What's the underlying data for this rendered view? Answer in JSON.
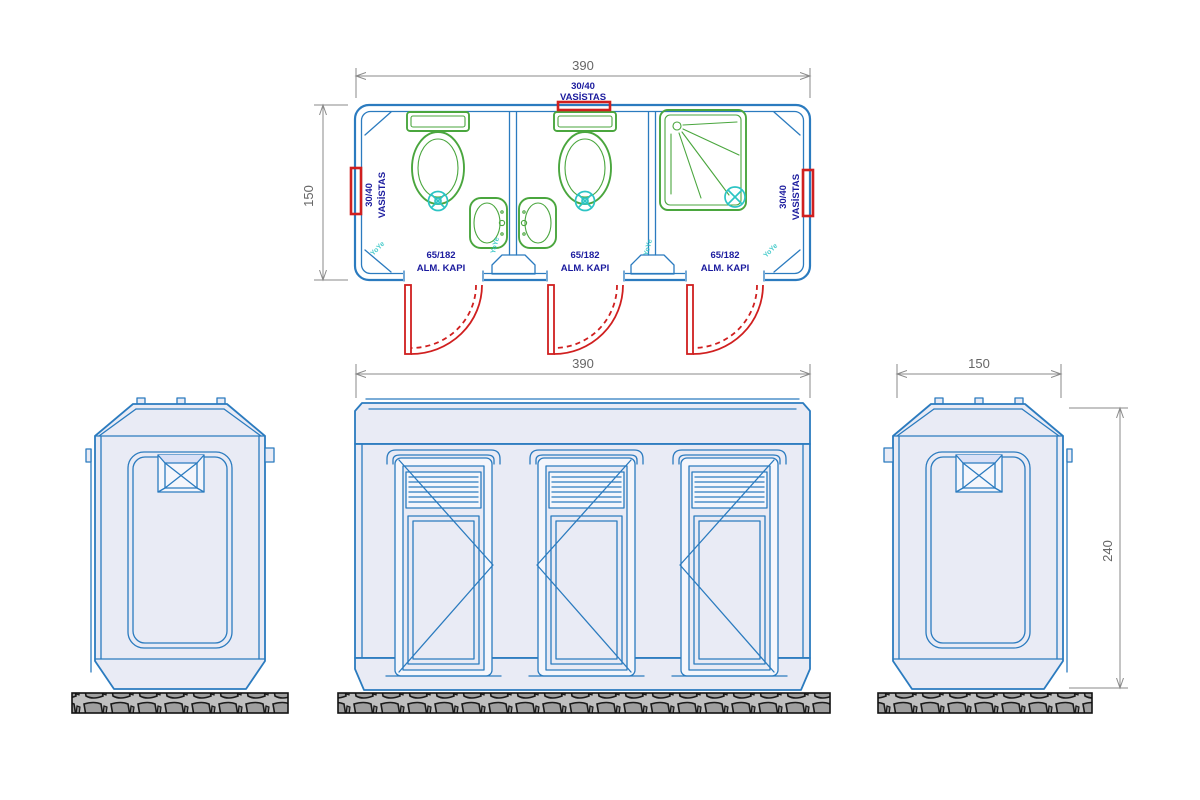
{
  "plan": {
    "width_dim": "390",
    "depth_dim": "150",
    "vasistas": {
      "size": "30/40",
      "name": "VASİSTAS"
    },
    "door": {
      "size": "65/182",
      "name": "ALM. KAPI"
    },
    "watermark": "YoYe"
  },
  "elevations": {
    "front_width_dim": "390",
    "side_width_dim": "150",
    "height_dim": "240"
  },
  "colors": {
    "wall_blue": "#2b7bbf",
    "fixture_green": "#4aa63e",
    "plumbing_cyan": "#2cc4c4",
    "accent_red": "#d01f1f",
    "label_navy": "#1b1b9e",
    "dim_gray": "#6b6b6b",
    "body_fill": "#e9ebf5",
    "ground_gray": "#bdbdbd"
  }
}
